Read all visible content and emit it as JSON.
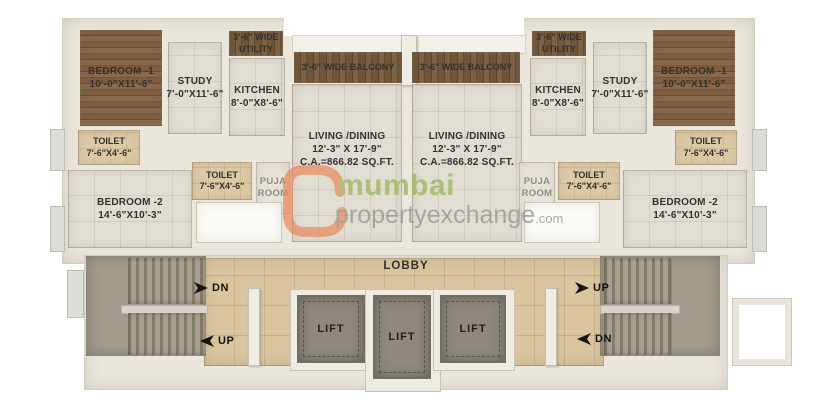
{
  "watermark": {
    "brand": "mumbai",
    "brand2": "propertyexchange",
    "tld": ".com"
  },
  "rooms": {
    "bedroom1": {
      "name": "BEDROOM -1",
      "dims": "10'-0\"X11'-6\""
    },
    "study": {
      "name": "STUDY",
      "dims": "7'-0\"X11'-6\""
    },
    "kitchen": {
      "name": "KITCHEN",
      "dims": "8'-0\"X8'-6\""
    },
    "utility": {
      "line1": "3'-6\" WIDE",
      "line2": "UTILITY"
    },
    "balcony": {
      "name": "3'-6\" WIDE BALCONY"
    },
    "living": {
      "name": "LIVING /DINING",
      "dims": "12'-3\" X 17'-9\"",
      "area": "C.A.=866.82 SQ.FT."
    },
    "toilet": {
      "name": "TOILET",
      "dims": "7'-6\"X4'-6\""
    },
    "bedroom2": {
      "name": "BEDROOM -2",
      "dims": "14'-6\"X10'-3\""
    },
    "puja": {
      "line1": "PUJA",
      "line2": "ROOM"
    },
    "lobby": {
      "name": "LOBBY"
    },
    "lift": {
      "name": "LIFT"
    }
  },
  "stairs": {
    "down": "DN",
    "up": "UP"
  },
  "colors": {
    "wall_cream": "#ebe7dd",
    "floor_tile": "#e2ddd3",
    "lobby_tan": "#d9c69e",
    "toilet_tan": "#dcc9a5",
    "wood_bedroom": "#7c5b3d",
    "wood_balcony": "#6f5539",
    "lift_gray": "#8f897d",
    "watermark_orange": "#e98a59",
    "watermark_green": "#a6ba6a",
    "watermark_gray": "#9d9d9a"
  }
}
